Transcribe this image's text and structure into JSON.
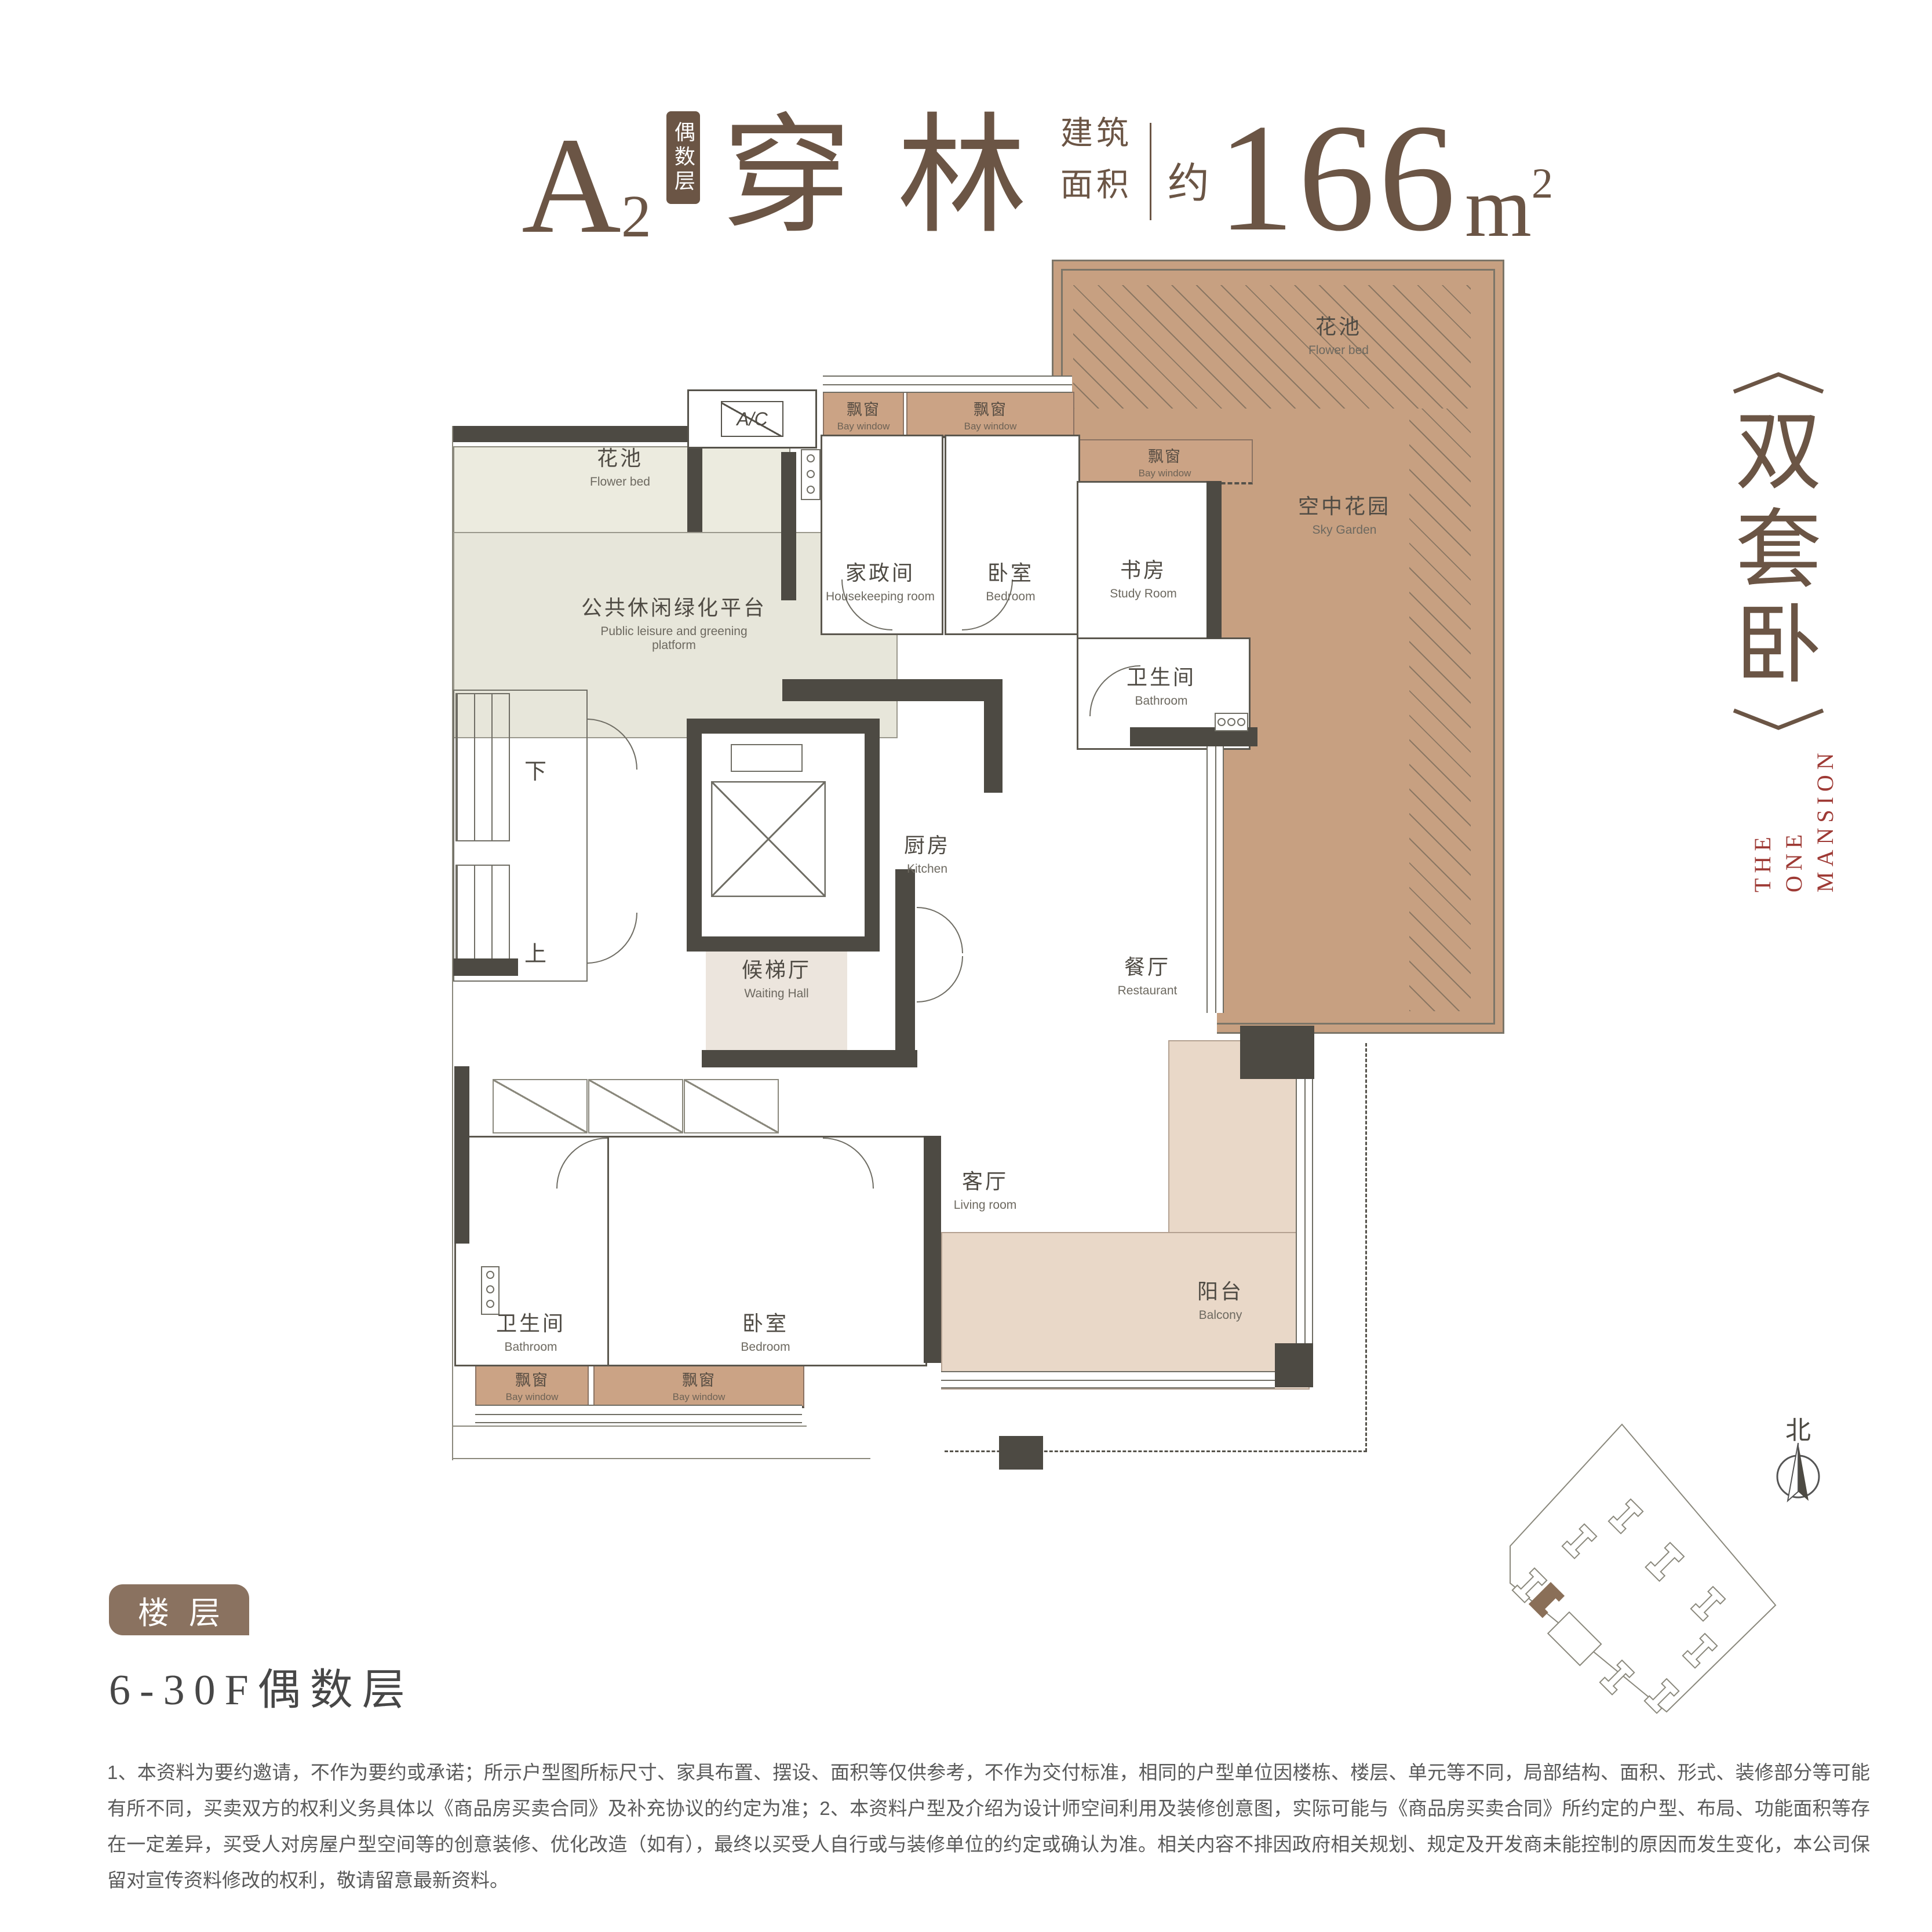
{
  "header": {
    "unit": "A",
    "unit_sub": "2",
    "badge": "偶数层",
    "name": "穿林",
    "area_label_top": "建筑",
    "area_label_bottom": "面积",
    "approx": "约",
    "area_value": "166",
    "area_unit": "m",
    "area_sup": "2"
  },
  "side_tag": {
    "chars": [
      "双",
      "套",
      "卧"
    ],
    "brand_line1": "THE",
    "brand_line2": "ONE MANSION"
  },
  "floor_section": {
    "badge": "楼层",
    "value": "6-30F偶数层"
  },
  "plan": {
    "flower_bed": {
      "cn": "花池",
      "en": "Flower bed"
    },
    "platform": {
      "cn": "公共休闲绿化平台",
      "en": "Public leisure and greening platform"
    },
    "sky_garden": {
      "cn": "空中花园",
      "en": "Sky Garden"
    },
    "bay_window": {
      "cn": "飘窗",
      "en": "Bay window"
    },
    "housekeeping": {
      "cn": "家政间",
      "en": "Housekeeping room"
    },
    "bedroom": {
      "cn": "卧室",
      "en": "Bedroom"
    },
    "study": {
      "cn": "书房",
      "en": "Study Room"
    },
    "bathroom": {
      "cn": "卫生间",
      "en": "Bathroom"
    },
    "kitchen": {
      "cn": "厨房",
      "en": "Kitchen"
    },
    "waiting_hall": {
      "cn": "候梯厅",
      "en": "Waiting Hall"
    },
    "restaurant": {
      "cn": "餐厅",
      "en": "Restaurant"
    },
    "living_room": {
      "cn": "客厅",
      "en": "Living room"
    },
    "balcony": {
      "cn": "阳台",
      "en": "Balcony"
    },
    "ac": "A/C",
    "stair_down": "下",
    "stair_up": "上"
  },
  "site_plan": {
    "north": "北"
  },
  "disclaimer": "1、本资料为要约邀请，不作为要约或承诺；所示户型图所标尺寸、家具布置、摆设、面积等仅供参考，不作为交付标准，相同的户型单位因楼栋、楼层、单元等不同，局部结构、面积、形式、装修部分等可能有所不同，买卖双方的权利义务具体以《商品房买卖合同》及补充协议的约定为准；2、本资料户型及介绍为设计师空间利用及装修创意图，实际可能与《商品房买卖合同》所约定的户型、布局、功能面积等存在一定差异，买受人对房屋户型空间等的创意装修、优化改造（如有），最终以买受人自行或与装修单位的约定或确认为准。相关内容不排因政府相关规划、规定及开发商未能控制的原因而发生变化，本公司保留对宣传资料修改的权利，敬请留意最新资料。",
  "colors": {
    "title_brown": "#6b5545",
    "brand_red": "#9e3a35",
    "garden_fill": "#c7a081",
    "bay_fill": "#cba385",
    "balcony_fill": "#e9d8c8",
    "hall_fill": "#ece5dd",
    "platform_fill": "#e7e6da",
    "flowerbed_fill": "#ecebdf",
    "wall_dark": "#4d4a43",
    "floor_badge": "#8a7260"
  }
}
